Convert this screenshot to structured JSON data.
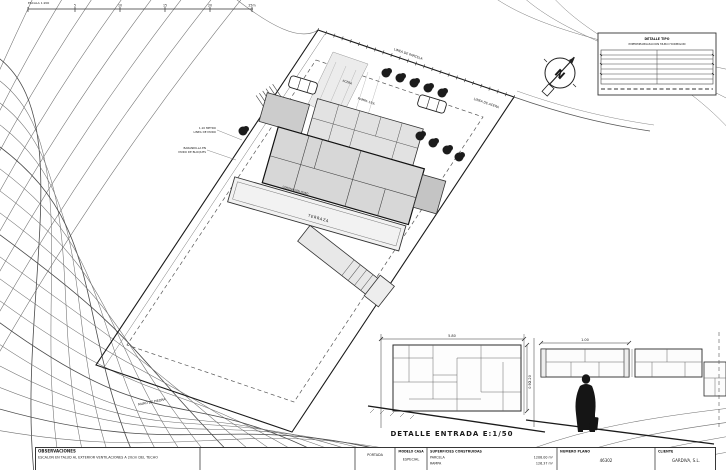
{
  "colors": {
    "paper": "#ffffff",
    "ink": "#1a1a1a",
    "building_fill": "#d8d8d8"
  },
  "drawing": {
    "scale": {
      "caption": "ESCALA 1:200",
      "ticks": [
        "5",
        "10",
        "15",
        "20",
        "25m"
      ]
    },
    "north_letter": "N",
    "detail_box": {
      "line1": "DETALLE TIPO",
      "line2": "IMPERMEABILIZACION MURO HORMIGON"
    },
    "detail_title": "DETALLE ENTRADA   E:1/50",
    "labels": {
      "linea_parcela": "LINEA DE PARCELA",
      "linea_acera": "LINEA DE ACERA",
      "acera": "ACERA",
      "rampa": "RAMPA 15%",
      "cota1_l1": "1,10 METRO",
      "cota1_l2": "LINEA DE MURO",
      "cota2_l1": "BARANDILLA EN",
      "cota2_l2": "MURO DE BLOQUES",
      "terraza": "TERRAZA",
      "coronacion": "CORONACION MURO",
      "muro_piedra": "MURO DE PIEDRA"
    },
    "dims": {
      "wall_width": "5.80",
      "wall_height": "2.20",
      "fence_panel": "1.00",
      "fence_height": "0.90"
    }
  },
  "title_block": {
    "observaciones_label": "OBSERVACIONES",
    "observaciones_text": "ESCALON EN TALUD AL EXTERIOR VENTILACIONES A 20cm DEL TECHO",
    "portada_label": "PORTADA",
    "modelo_label": "MODELO CASA",
    "modelo_value": "ESPECIAL",
    "superficies_label": "SUPERFICIES CONSTRUIDAS",
    "superficies_rows": [
      {
        "name": "PARCELA",
        "value": "1208.00 m²"
      },
      {
        "name": "RAMPA",
        "value": "126.37 m²"
      }
    ],
    "numero_label": "NUMERO PLANO",
    "numero_value": "46302",
    "cliente_label": "CLIENTE",
    "cliente_value": "GARDIVA, S.L."
  }
}
